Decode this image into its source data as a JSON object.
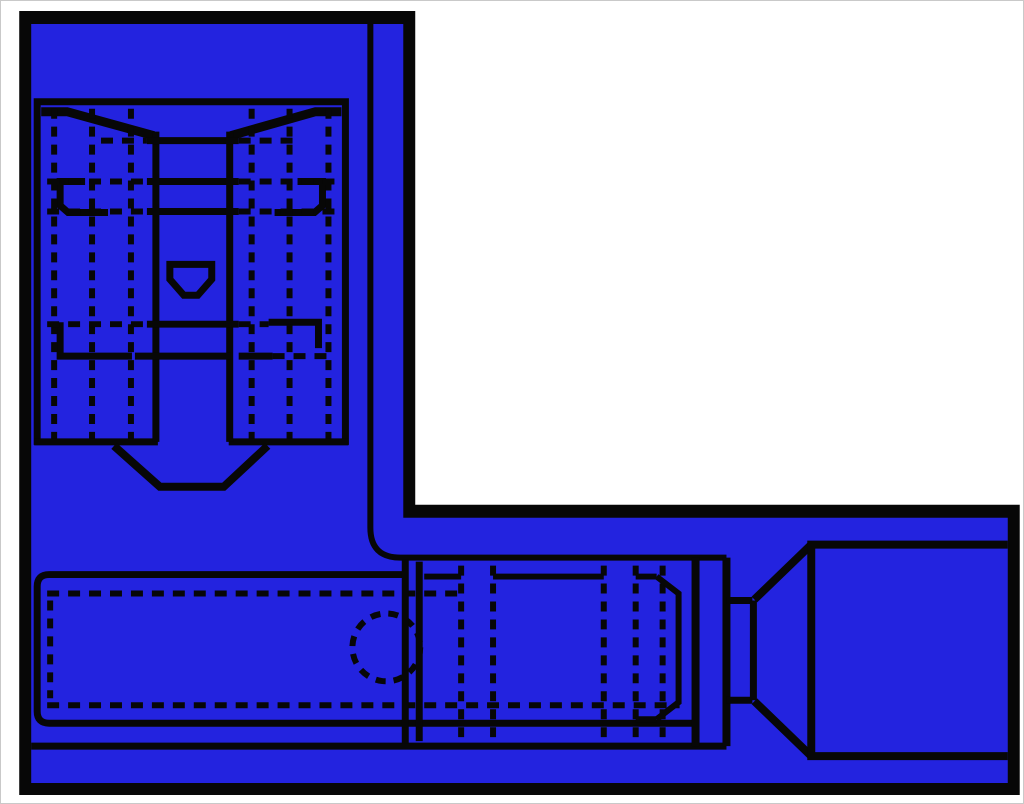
{
  "image": {
    "description": "Technical two-view line drawing of a blue fully-insulated flag-style quick-disconnect crimp terminal. The L-shaped blue body is outlined in a thick black border; the vertical arm shows the female receptacle from above with dashed hidden lines, the horizontal arm shows the side view with blade, crimp barrel, dashed inspection hole and flared wire-entry funnel.",
    "text_content": "none"
  },
  "colors": {
    "background": "#ffffff",
    "frame": "#c9c9c9",
    "blue": "#2323DF",
    "ink": "#070707"
  },
  "parts": {
    "body": "insulated-terminal-body",
    "top_view": "receptacle-top-view",
    "side_view": "crimp-side-view",
    "dimple": "contact-dimple-pocket",
    "inspection_hole": "hidden-inspection-hole",
    "funnel": "flared-wire-entry-funnel",
    "wire_sleeve": "wire-entry-sleeve"
  }
}
